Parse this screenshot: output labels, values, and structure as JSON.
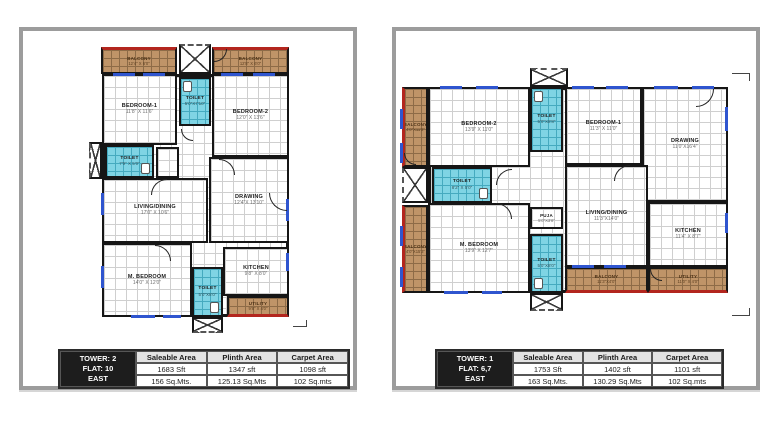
{
  "colors": {
    "wall": "#161616",
    "toilet_fill": "#7fd4e4",
    "balcony_fill": "#bf9468",
    "balcony_edge_red": "#b3261e",
    "window_blue": "#2f55cf",
    "table_header_bg": "#e3e3e3",
    "table_tower_bg": "#1d1d1d"
  },
  "plans": [
    {
      "id": "tower-2",
      "rooms": {
        "balcony_left": {
          "name": "BALCONY",
          "dims": "12'4\" X 6'0\""
        },
        "balcony_right": {
          "name": "BALCONY",
          "dims": "12'8\" X 6'0\""
        },
        "bedroom1": {
          "name": "BEDROOM-1",
          "dims": "11'8\" X 11'6\""
        },
        "toilet_top": {
          "name": "TOILET",
          "dims": "5'0\"X7'10\""
        },
        "bedroom2": {
          "name": "BEDROOM-2",
          "dims": "12'0\" X 13'6\""
        },
        "toilet_mid": {
          "name": "TOILET",
          "dims": "7'9\" X 5'0\""
        },
        "living": {
          "name": "LIVING/DINING",
          "dims": "17'0\" X 10'6\""
        },
        "drawing": {
          "name": "DRAWING",
          "dims": "12'4\"X 13'10\""
        },
        "m_bedroom": {
          "name": "M. BEDROOM",
          "dims": "14'0\" X 12'0\""
        },
        "toilet_bottom": {
          "name": "TOILET",
          "dims": "5'0\"X8'0\""
        },
        "kitchen": {
          "name": "KITCHEN",
          "dims": "9'8\" X 8'0\""
        },
        "utility": {
          "name": "UTILITY",
          "dims": "9'8\" X 4'0\""
        }
      },
      "table": {
        "tower": "TOWER: 2",
        "flat": "FLAT: 10",
        "facing": "EAST",
        "headers": [
          "Saleable Area",
          "Plinth Area",
          "Carpet Area"
        ],
        "sft": [
          "1683 Sft",
          "1347 sft",
          "1098 sft"
        ],
        "mts": [
          "156 Sq.Mts.",
          "125.13 Sq.Mts",
          "102 Sq.mts"
        ]
      }
    },
    {
      "id": "tower-1",
      "rooms": {
        "balcony_tl": {
          "name": "BALCONY",
          "dims": "4'0\"X11'8\""
        },
        "bedroom2": {
          "name": "BEDROOM-2",
          "dims": "13'9\" X 11'0\""
        },
        "toilet_top": {
          "name": "TOILET",
          "dims": "5'0\"X8'8\""
        },
        "bedroom1": {
          "name": "BEDROOM-1",
          "dims": "11'3\" X 11'0\""
        },
        "drawing": {
          "name": "DRAWING",
          "dims": "11'0\"X16'4\""
        },
        "toilet_mid": {
          "name": "TOILET",
          "dims": "8'2\" X 5'0\""
        },
        "balcony_bl": {
          "name": "BALCONY",
          "dims": "4'0\"X15'3\""
        },
        "m_bedroom": {
          "name": "M. BEDROOM",
          "dims": "13'9\" X 12'7\""
        },
        "puja": {
          "name": "PUJA",
          "dims": "5'0\"X3'8\""
        },
        "living": {
          "name": "LIVING/DINING",
          "dims": "11'3\"X14'0\""
        },
        "kitchen": {
          "name": "KITCHEN",
          "dims": "11'4\" X 8'7\""
        },
        "toilet_bottom": {
          "name": "TOILET",
          "dims": "5'0\"X8'0\""
        },
        "balcony_bottom": {
          "name": "BALCONY",
          "dims": "11'3\"X4'0\""
        },
        "utility": {
          "name": "UTILITY",
          "dims": "11'0\" X 4'0\""
        }
      },
      "table": {
        "tower": "TOWER: 1",
        "flat": "FLAT: 6,7",
        "facing": "EAST",
        "headers": [
          "Saleable Area",
          "Plinth Area",
          "Carpet Area"
        ],
        "sft": [
          "1753 Sft",
          "1402 sft",
          "1101 sft"
        ],
        "mts": [
          "163 Sq.Mts.",
          "130.29 Sq.Mts",
          "102 Sq.mts"
        ]
      }
    }
  ]
}
